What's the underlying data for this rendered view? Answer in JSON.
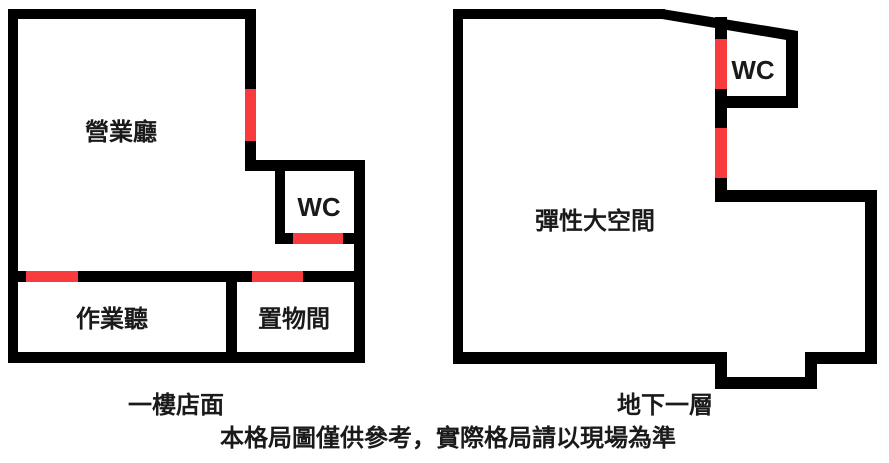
{
  "colors": {
    "wall": "#000000",
    "door_marker": "#f83b3c",
    "background": "#ffffff",
    "label_text": "#1a1a1a"
  },
  "plans": {
    "first_floor": {
      "caption": "一樓店面",
      "rooms": {
        "sales_hall": "營業廳",
        "wc": "WC",
        "work_room": "作業聽",
        "storage_room": "置物間"
      }
    },
    "basement": {
      "caption": "地下一層",
      "rooms": {
        "flexible_space": "彈性大空間",
        "wc": "WC"
      }
    }
  },
  "disclaimer": "本格局圖僅供參考，實際格局請以現場為準"
}
